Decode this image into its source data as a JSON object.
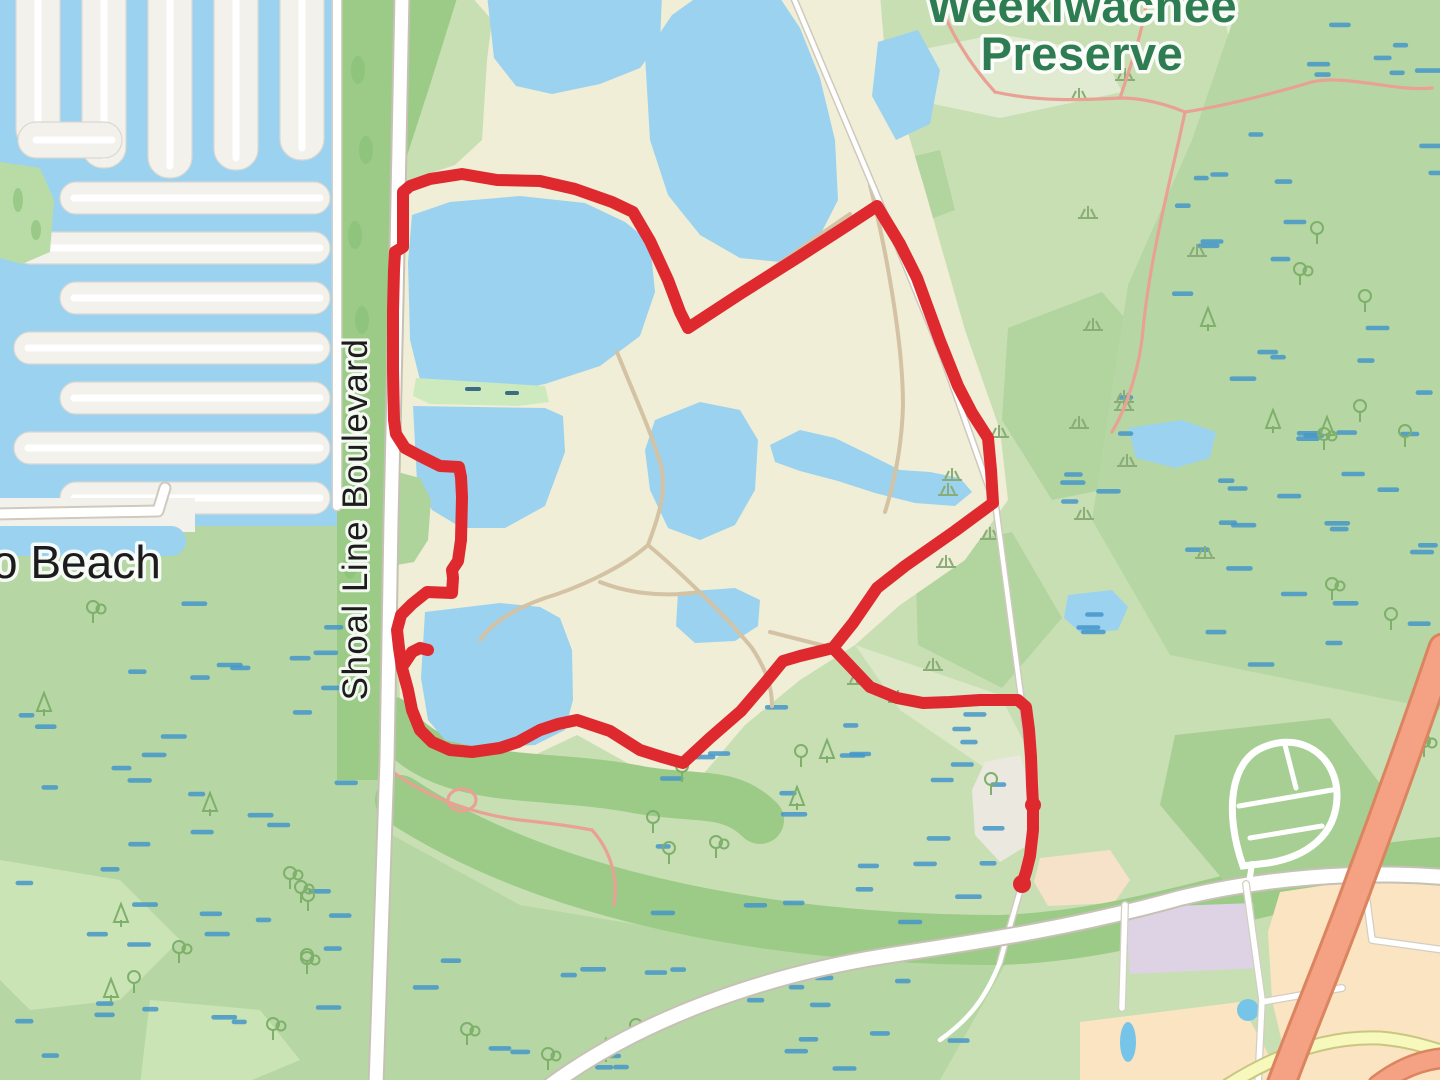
{
  "map": {
    "labels": {
      "preserve_line1": "Weekiwachee",
      "preserve_line2": "Preserve",
      "preserve_color": "#2e7d52",
      "boulevard": "Shoal Line Boulevard",
      "beach_partial": "o Beach",
      "place_color": "#1c1c1c"
    },
    "colors": {
      "water": "#9bd2ef",
      "quarry_sand": "#f0eed6",
      "green_base": "#c8dfb4",
      "marsh_green": "#b6d7a4",
      "forest_green": "#9bcb87",
      "scrub_green": "#b2d49e",
      "marsh_dash_blue": "#4597c9",
      "track_red": "#de2a2e",
      "trunk_orange": "#f5a183",
      "road_yellow": "#f6f8bc",
      "path_tan": "#d4c2a4",
      "path_salmon": "#e9a193",
      "residential_peach": "#fbe4c1",
      "retail_lavender": "#ddd3e4",
      "pool_blue": "#76c5e8"
    },
    "track": {
      "color": "#de2a2e",
      "width": 12,
      "loop_points": "403,192 410,186 430,179 462,174 497,180 540,181 575,189 612,202 633,212 650,241 668,280 680,312 688,328 740,294 800,256 845,227 877,206 900,244 917,278 940,341 958,386 972,413 988,438 991,470 993,503 955,531 905,566 877,588 853,623 833,648 800,656 783,661 765,683 741,711 710,738 683,763 662,757 640,750 610,731 577,720 558,724 540,730 518,742 500,748 472,752 450,750 432,742 420,730 412,710 408,690 402,668 399,648 397,630 401,615 412,604 427,592 452,593 453,578 452,570 458,561 461,540 462,497 461,477 459,467 440,466 420,456 405,448 396,434 394,420 393,370 393,310 394,270 395,252 403,247 403,215",
      "tail_points": "833,648 852,668 870,687 897,698 923,703 950,702 980,700 1018,700 1026,707 1029,730 1031,757 1032,785 1033,805 1033,830 1030,856 1026,872 1022,884",
      "spur_points": "404,664 412,652 420,648 428,650",
      "end_marker": {
        "cx": 1022,
        "cy": 884,
        "r": 9
      },
      "mid_marker": {
        "cx": 1033,
        "cy": 805,
        "r": 8
      }
    }
  }
}
